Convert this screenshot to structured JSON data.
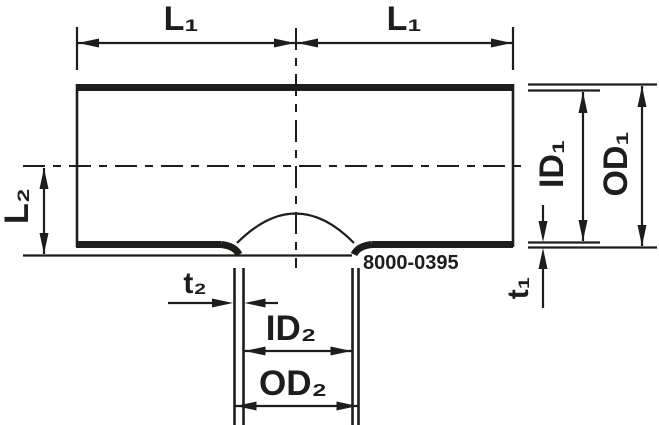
{
  "drawing": {
    "type": "engineering-dimension-diagram",
    "subject": "tee-fitting-cross-section",
    "part_number": "8000-0395",
    "labels": {
      "l1_left": "L₁",
      "l1_right": "L₁",
      "l2": "L₂",
      "id1": "ID₁",
      "od1": "OD₁",
      "t1": "t₁",
      "t2": "t₂",
      "id2": "ID₂",
      "od2": "OD₂"
    },
    "colors": {
      "line": "#1d1d1b",
      "background": "#ffffff"
    }
  }
}
